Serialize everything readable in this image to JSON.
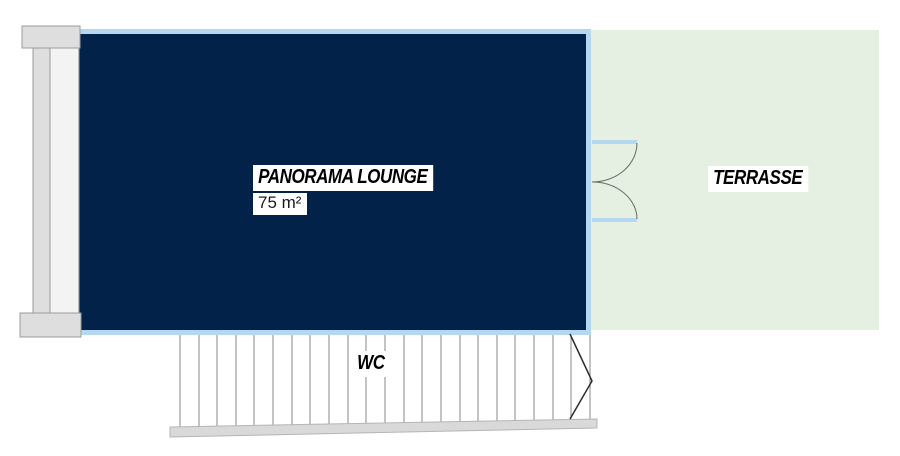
{
  "rooms": {
    "lounge": {
      "label": "PANORAMA LOUNGE",
      "area": "75 m²"
    },
    "terrasse": {
      "label": "TERRASSE"
    },
    "wc": {
      "label": "WC"
    }
  },
  "colors": {
    "lounge_fill": "#03224a",
    "lounge_wall_border": "#b3d8f0",
    "terrasse_fill": "#e5f0e3",
    "column_fill": "#dedede",
    "column_highlight": "#f3f3f3",
    "column_stroke": "#9b9b9b",
    "stair_line": "#8a8a8a",
    "stair_base_fill": "#d9d9d9",
    "door_arc_stroke": "#667066",
    "label_background": "#ffffff",
    "label_text": "#000000"
  }
}
